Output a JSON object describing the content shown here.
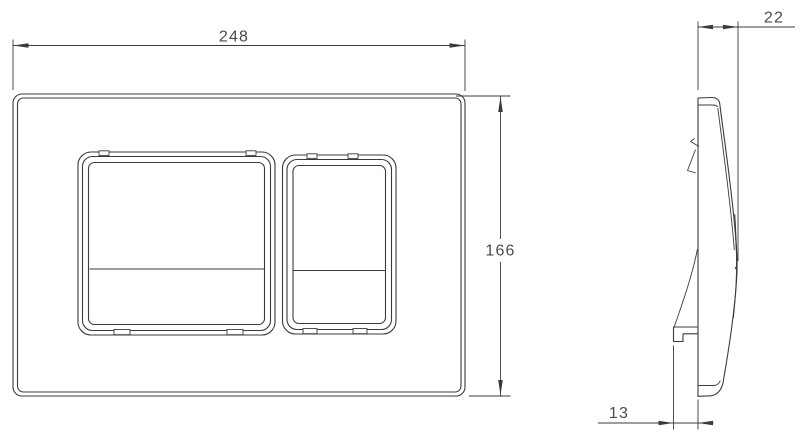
{
  "drawing": {
    "type": "technical-dimension-drawing",
    "subject": "dual-flush-plate",
    "line_color": "#3b3b3b",
    "text_color": "#4a4a4a",
    "background_color": "#ffffff",
    "labels": {
      "front_width": "248",
      "front_height": "166",
      "side_depth": "22",
      "side_offset": "13"
    }
  }
}
